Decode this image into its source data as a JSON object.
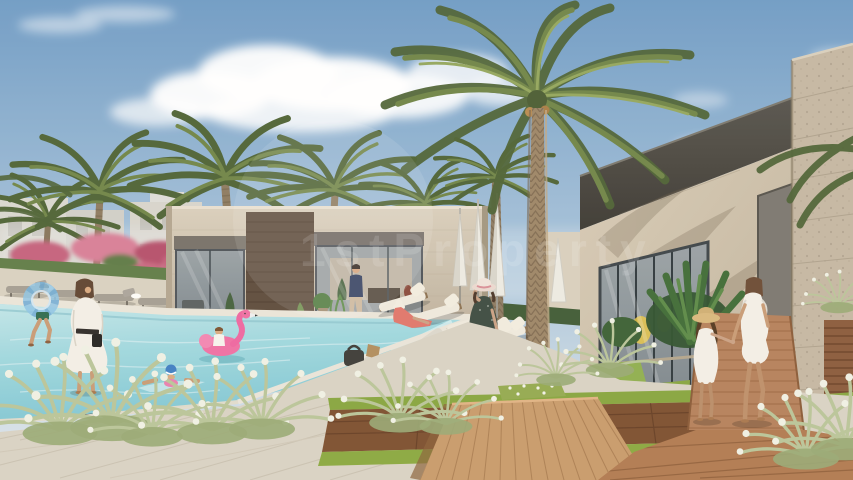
{
  "scene": {
    "description": "Daylight architectural rendering of a residential community clubhouse with swimming pool, date palms, sun loungers and residents",
    "watermark": {
      "text": "1stProperty"
    }
  },
  "palette": {
    "sky_top": "#6e9bc5",
    "sky_mid": "#a9c4da",
    "sky_horizon": "#e2e9ec",
    "cloud": "#ffffff",
    "palm_dark": "#4d6234",
    "palm_mid": "#6f8446",
    "palm_light": "#93a65c",
    "trunk": "#9c8566",
    "stone_wall": "#cfc4b0",
    "stone_pillar": "#c4b7a2",
    "wood_panel": "#5d4b3b",
    "fascia": "#3b3831",
    "glass": "#7e888d",
    "pool_light": "#c2e6e8",
    "pool_deep": "#7fc6d2",
    "coping": "#eae5d9",
    "paver": "#d8d2c3",
    "grass": "#86a53e",
    "deck_wood": "#b07a50",
    "platform_wood": "#c89a6a",
    "flamingo": "#ef6fa3",
    "swim_ring": "#8ec4e4",
    "white_dress": "#f3efe6",
    "coral_dress": "#e0756a",
    "navy_shirt": "#2e3a5c",
    "umbrella": "#eceae2",
    "foliage_dark": "#2e512c"
  }
}
